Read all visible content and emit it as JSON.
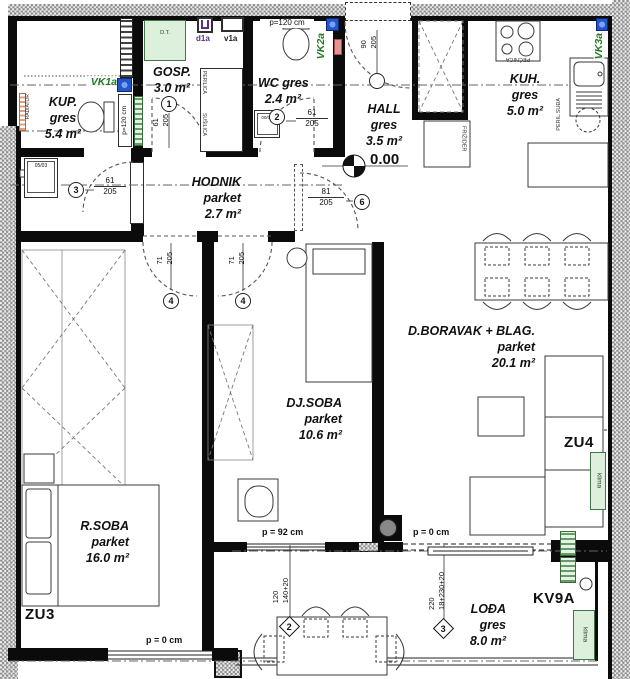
{
  "colors": {
    "wall": "#0b0b0b",
    "hatch_gray": "#8f8f8f",
    "vk_green": "#1e7a1e",
    "vent_blue": "#2456c4",
    "fixture_green": "#dcf0dc",
    "salmon": "#e49494",
    "purple": "#5b2d8e"
  },
  "rooms": {
    "kup": {
      "l1": "KUP.",
      "l2": "gres",
      "l3": "5.4 m²"
    },
    "gosp": {
      "l1": "GOSP.",
      "l2": "3.0 m²"
    },
    "wc": {
      "l1": "WC gres",
      "l2": "2.4 m²"
    },
    "hall": {
      "l1": "HALL",
      "l2": "gres",
      "l3": "3.5 m²"
    },
    "kuh": {
      "l1": "KUH.",
      "l2": "gres",
      "l3": "5.0 m²"
    },
    "hodnik": {
      "l1": "HODNIK",
      "l2": "parket",
      "l3": "2.7 m²"
    },
    "boravak": {
      "l1": "D.BORAVAK + BLAG.",
      "l2": "parket",
      "l3": "20.1 m²"
    },
    "djsoba": {
      "l1": "DJ.SOBA",
      "l2": "parket",
      "l3": "10.6 m²"
    },
    "rsoba": {
      "l1": "R.SOBA",
      "l2": "parket",
      "l3": "16.0 m²"
    },
    "lodja": {
      "l1": "LOĐA",
      "l2": "gres",
      "l3": "8.0 m²"
    }
  },
  "elevation": "0.00",
  "doors": {
    "d1": {
      "no": "1",
      "w": "61",
      "h": "205"
    },
    "d2": {
      "no": "2",
      "w": "61",
      "h": "205"
    },
    "d3": {
      "no": "3",
      "w": "61",
      "h": "205"
    },
    "d4a": {
      "no": "4",
      "w": "71",
      "h": "205"
    },
    "d4b": {
      "no": "4",
      "w": "71",
      "h": "205"
    },
    "d6": {
      "no": "6",
      "w": "81",
      "h": "205"
    },
    "entry": {
      "w": "90",
      "h": "205"
    }
  },
  "windows": {
    "w2": {
      "no": "2",
      "dim1": "120",
      "dim2": "140+20"
    },
    "w3": {
      "no": "3",
      "dim1": "220",
      "dim2": "18+230+20"
    }
  },
  "parapets": {
    "wc_top": "p=120 cm",
    "kup_side": "p=120 cm",
    "dj": "p = 92 cm",
    "liv": "p = 0 cm",
    "rsoba": "p = 0 cm"
  },
  "vents": {
    "vk1": "VK1a",
    "vk2": "VK2a",
    "vk3": "VK3a"
  },
  "marks": {
    "zu3": "ZU3",
    "zu4": "ZU4",
    "kv9a": "KV9A"
  },
  "fixtures": {
    "dt": "D.T.",
    "d1a": "d1a",
    "v1a": "v1a",
    "shower": "05/03",
    "wc_cab": "00/09",
    "radiator": "RADIATOR",
    "perilica": "PERILICA",
    "susilica": "SUŠILICA",
    "pecnica": "PEĆNICA",
    "peril_sudja": "PERIL.SUĐA",
    "frizider": "FRIŽIDER",
    "klima_zu4": "klima",
    "klima_kv9a": "klima"
  }
}
